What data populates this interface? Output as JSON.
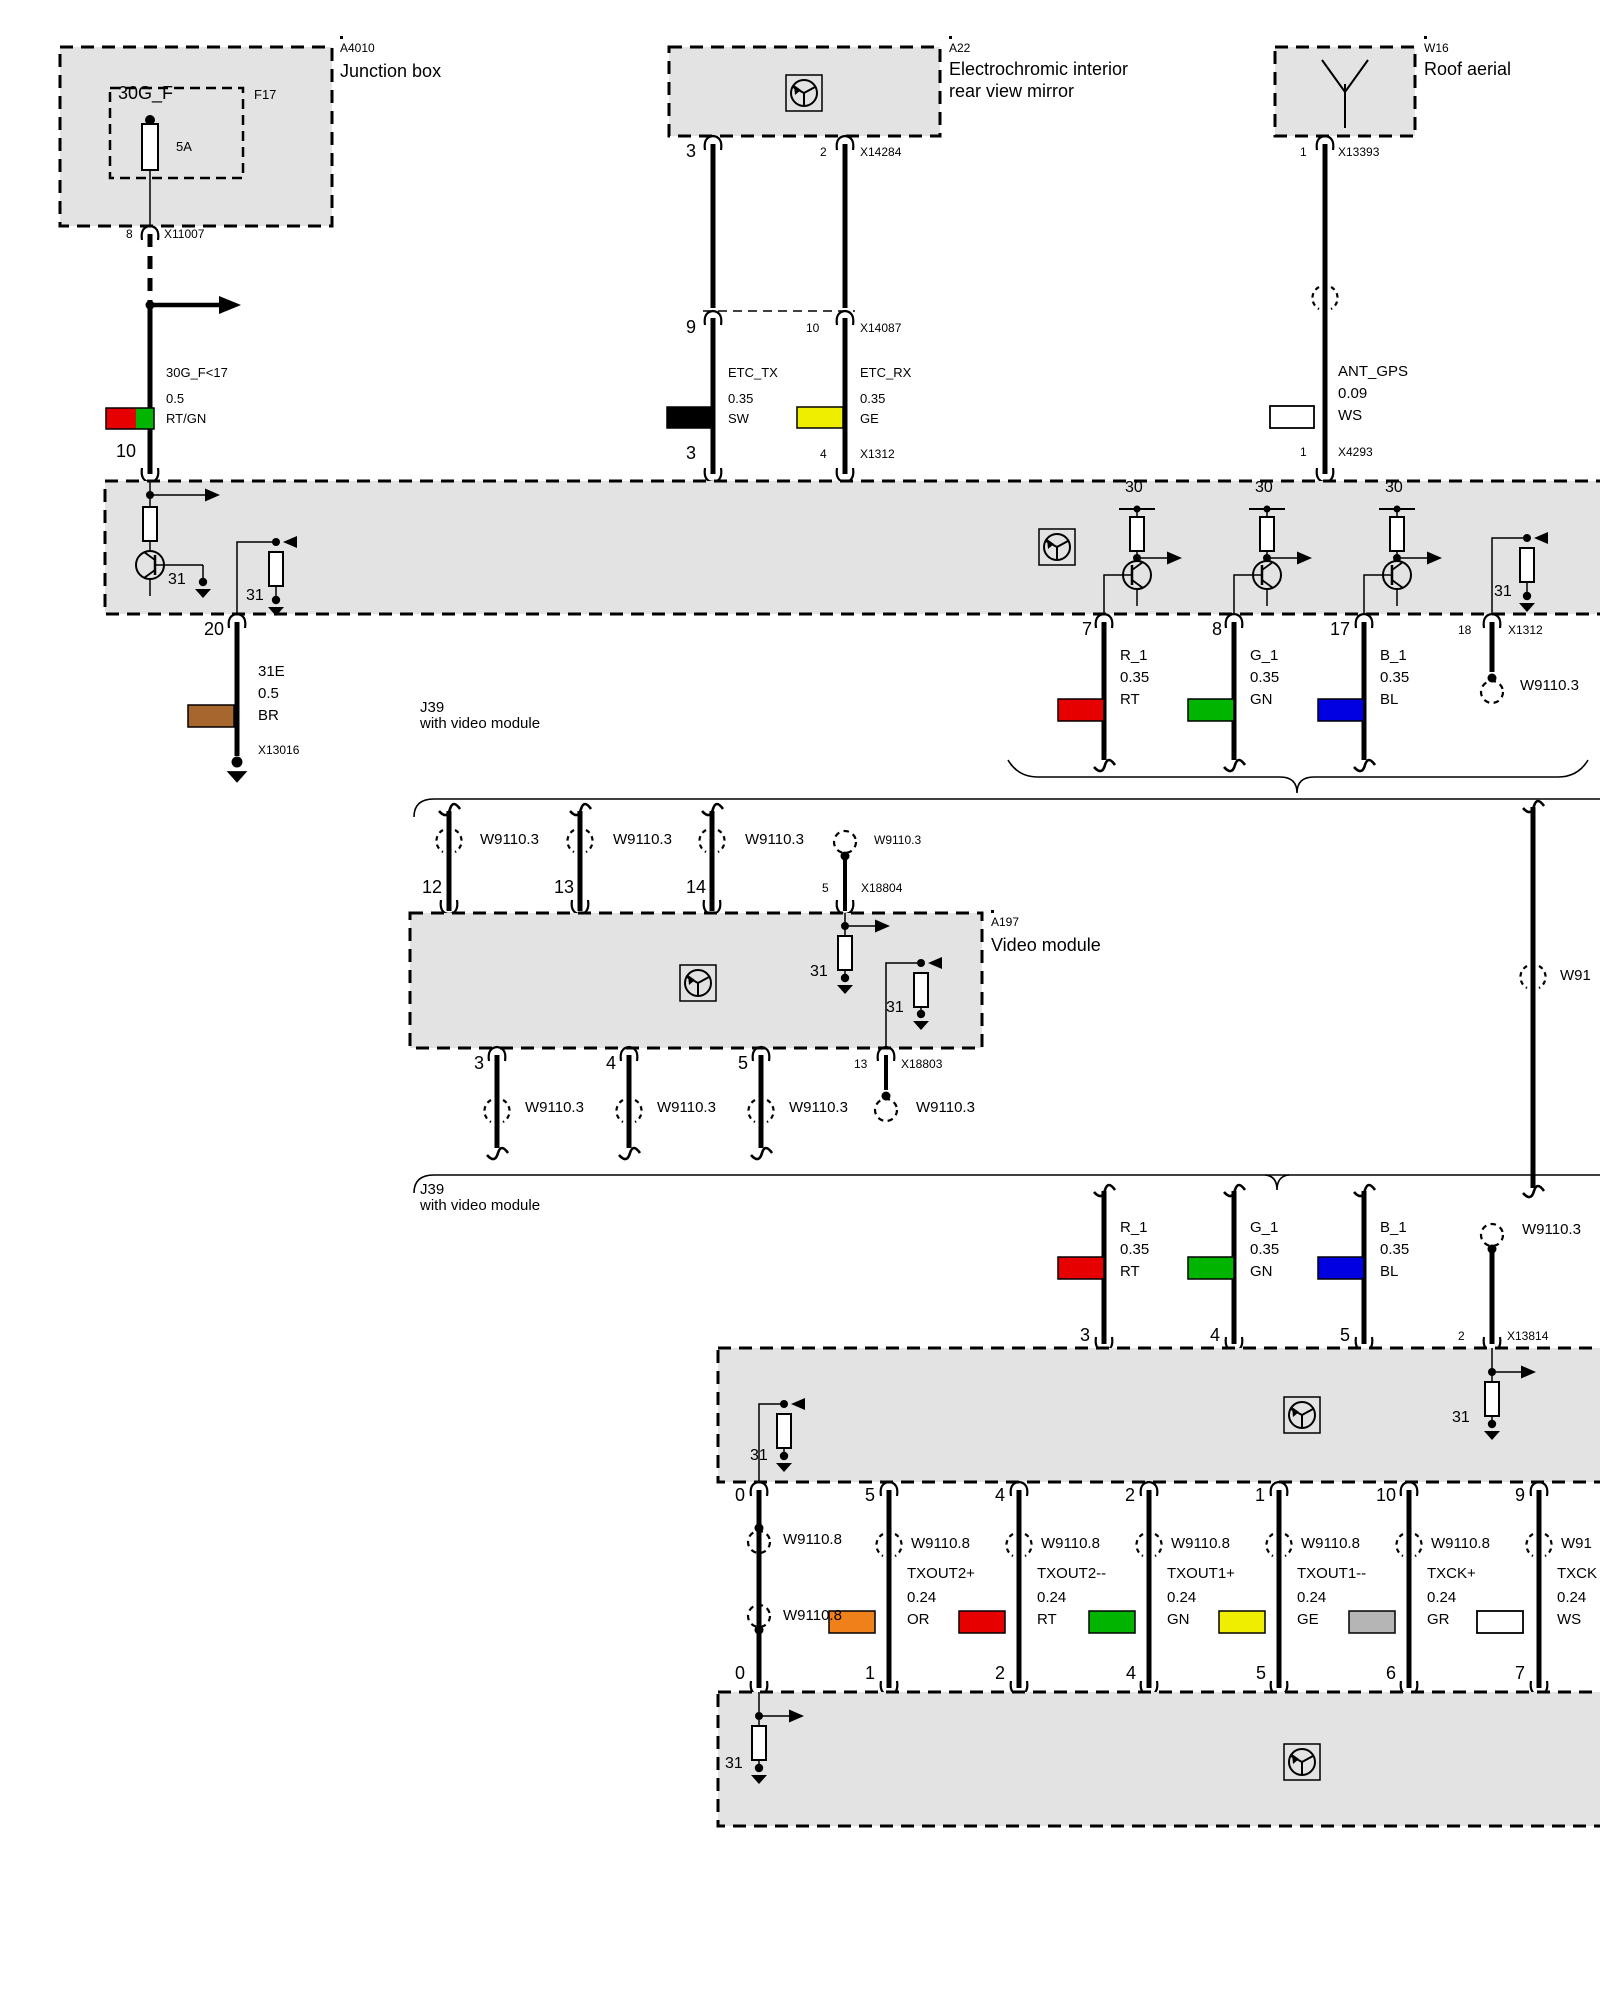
{
  "colors": {
    "red": "#e60000",
    "green": "#00b400",
    "blue": "#0000e0",
    "yellow": "#f0ee00",
    "orange": "#f08019",
    "gray": "#b5b5b5",
    "white": "#ffffff",
    "brown": "#a8662f",
    "black": "#000000"
  },
  "junction_box": {
    "ref": "A4010",
    "title": "Junction box",
    "fuse_signal": "30G_F",
    "fuse_ref": "F17",
    "fuse_rating": "5A",
    "pin": "8",
    "connector": "X11007"
  },
  "supply_wire": {
    "signal": "30G_F<17",
    "gauge": "0.5",
    "code": "RT/GN",
    "pin": "10"
  },
  "mirror": {
    "ref": "A22",
    "title_line1": "Electrochromic interior",
    "title_line2": "rear view mirror",
    "pin_left": "3",
    "pin_right": "2",
    "connector": "X14284"
  },
  "inline_connector": {
    "pin_left": "9",
    "pin_right": "10",
    "id": "X14087"
  },
  "etc_tx": {
    "signal": "ETC_TX",
    "gauge": "0.35",
    "code": "SW",
    "pin": "3"
  },
  "etc_rx": {
    "signal": "ETC_RX",
    "gauge": "0.35",
    "code": "GE",
    "pin": "4"
  },
  "aerial": {
    "ref": "W16",
    "title": "Roof aerial",
    "pin_top": "1",
    "connector_top": "X13393",
    "pin_bottom": "1",
    "connector_bottom": "X4293"
  },
  "ant_wire": {
    "signal": "ANT_GPS",
    "gauge": "0.09",
    "code": "WS"
  },
  "head_unit": {
    "supply": "30",
    "ground": "31",
    "pin_ground": "20",
    "pin_r": "7",
    "pin_g": "8",
    "pin_b": "17",
    "pin_shield": "18",
    "connector": "X1312"
  },
  "ground_wire": {
    "signal": "31E",
    "gauge": "0.5",
    "code": "BR",
    "connector": "X13016"
  },
  "rgb1": {
    "r_signal": "R_1",
    "r_gauge": "0.35",
    "r_code": "RT",
    "g_signal": "G_1",
    "g_gauge": "0.35",
    "g_code": "GN",
    "b_signal": "B_1",
    "b_gauge": "0.35",
    "b_code": "BL",
    "shield": "W9110.3"
  },
  "j39_upper": {
    "id": "J39",
    "note": "with video module"
  },
  "video_in": {
    "shield1": "W9110.3",
    "shield2": "W9110.3",
    "shield3": "W9110.3",
    "shield4": "W9110.3",
    "pin1": "12",
    "pin2": "13",
    "pin3": "14",
    "pin4": "5",
    "connector": "X18804"
  },
  "video_module": {
    "ref": "A197",
    "title": "Video module",
    "ground": "31"
  },
  "video_out": {
    "pin1": "3",
    "pin2": "4",
    "pin3": "5",
    "pin4": "13",
    "connector": "X18803",
    "shield1": "W9110.3",
    "shield2": "W9110.3",
    "shield3": "W9110.3",
    "shield4": "W9110.3"
  },
  "bypass_wire": {
    "shield": "W91"
  },
  "j39_lower": {
    "id": "J39",
    "note": "with video module"
  },
  "rgb2": {
    "r_signal": "R_1",
    "r_gauge": "0.35",
    "r_code": "RT",
    "g_signal": "G_1",
    "g_gauge": "0.35",
    "g_code": "GN",
    "b_signal": "B_1",
    "b_gauge": "0.35",
    "b_code": "BL",
    "shield": "W9110.3",
    "pin_r": "3",
    "pin_g": "4",
    "pin_b": "5",
    "pin_shield": "2",
    "connector": "X13814"
  },
  "monitor": {
    "ground": "31",
    "pins_top": [
      "0",
      "5",
      "4",
      "2",
      "1",
      "10",
      "9"
    ],
    "pins_bottom": [
      "0",
      "1",
      "2",
      "4",
      "5",
      "6",
      "7"
    ]
  },
  "tx_first": {
    "shield_top": "W9110.8",
    "shield_bottom": "W9110.8"
  },
  "tx_wires": [
    {
      "shield": "W9110.8",
      "signal": "TXOUT2+",
      "gauge": "0.24",
      "code": "OR"
    },
    {
      "shield": "W9110.8",
      "signal": "TXOUT2--",
      "gauge": "0.24",
      "code": "RT"
    },
    {
      "shield": "W9110.8",
      "signal": "TXOUT1+",
      "gauge": "0.24",
      "code": "GN"
    },
    {
      "shield": "W9110.8",
      "signal": "TXOUT1--",
      "gauge": "0.24",
      "code": "GE"
    },
    {
      "shield": "W9110.8",
      "signal": "TXCK+",
      "gauge": "0.24",
      "code": "GR"
    },
    {
      "shield": "W91",
      "signal": "TXCK",
      "gauge": "0.24",
      "code": "WS"
    }
  ],
  "display_unit": {
    "ground": "31"
  }
}
